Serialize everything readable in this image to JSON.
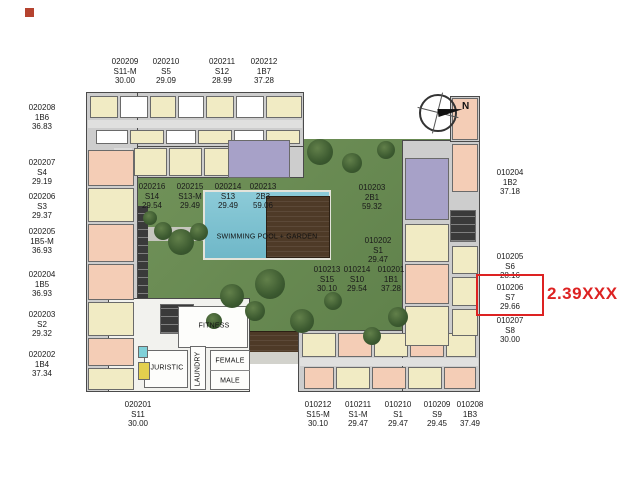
{
  "annotation": {
    "price_text": "2.39XXX",
    "highlight_color": "#dd2222",
    "highlighted_unit": "010206"
  },
  "compass": {
    "label": "N"
  },
  "facilities": {
    "pool_garden": "SWIMMING POOL + GARDEN",
    "fitness": "FITNESS",
    "juristic": "JURISTIC",
    "laundry": "LAUNDRY",
    "female": "FEMALE",
    "male": "MALE"
  },
  "colors": {
    "unit_cream": "#f1ebc4",
    "unit_salmon": "#f4cdb6",
    "unit_lavender": "#a7a1c8",
    "garden_green": "#6e9055",
    "pool_blue": "#7ec5d2",
    "deck_brown": "#4e3a27",
    "highlight_red": "#dd2222"
  },
  "units": [
    {
      "code": "020209",
      "type": "S11-M",
      "area": "30.00",
      "x": 125,
      "y": 57
    },
    {
      "code": "020210",
      "type": "S5",
      "area": "29.09",
      "x": 166,
      "y": 57
    },
    {
      "code": "020211",
      "type": "S12",
      "area": "28.99",
      "x": 222,
      "y": 57
    },
    {
      "code": "020212",
      "type": "1B7",
      "area": "37.28",
      "x": 264,
      "y": 57
    },
    {
      "code": "020208",
      "type": "1B6",
      "area": "36.83",
      "x": 42,
      "y": 103
    },
    {
      "code": "020207",
      "type": "S4",
      "area": "29.19",
      "x": 42,
      "y": 158
    },
    {
      "code": "020206",
      "type": "S3",
      "area": "29.37",
      "x": 42,
      "y": 192
    },
    {
      "code": "020205",
      "type": "1B5-M",
      "area": "36.93",
      "x": 42,
      "y": 227
    },
    {
      "code": "020204",
      "type": "1B5",
      "area": "36.93",
      "x": 42,
      "y": 270
    },
    {
      "code": "020203",
      "type": "S2",
      "area": "29.32",
      "x": 42,
      "y": 310
    },
    {
      "code": "020202",
      "type": "1B4",
      "area": "37.34",
      "x": 42,
      "y": 350
    },
    {
      "code": "020201",
      "type": "S11",
      "area": "30.00",
      "x": 138,
      "y": 400
    },
    {
      "code": "020216",
      "type": "S14",
      "area": "29.54",
      "x": 152,
      "y": 182
    },
    {
      "code": "020215",
      "type": "S13-M",
      "area": "29.49",
      "x": 190,
      "y": 182
    },
    {
      "code": "020214",
      "type": "S13",
      "area": "29.49",
      "x": 228,
      "y": 182
    },
    {
      "code": "020213",
      "type": "2B3",
      "area": "59.06",
      "x": 263,
      "y": 182
    },
    {
      "code": "010203",
      "type": "2B1",
      "area": "59.32",
      "x": 372,
      "y": 183
    },
    {
      "code": "010202",
      "type": "S1",
      "area": "29.47",
      "x": 378,
      "y": 236
    },
    {
      "code": "010213",
      "type": "S15",
      "area": "30.10",
      "x": 327,
      "y": 265
    },
    {
      "code": "010214",
      "type": "S10",
      "area": "29.54",
      "x": 357,
      "y": 265
    },
    {
      "code": "010201",
      "type": "1B1",
      "area": "37.28",
      "x": 391,
      "y": 265
    },
    {
      "code": "010204",
      "type": "1B2",
      "area": "37.18",
      "x": 510,
      "y": 168
    },
    {
      "code": "010205",
      "type": "S6",
      "area": "28.16",
      "x": 510,
      "y": 252
    },
    {
      "code": "010206",
      "type": "S7",
      "area": "29.66",
      "x": 510,
      "y": 283,
      "boxed": true
    },
    {
      "code": "010207",
      "type": "S8",
      "area": "30.00",
      "x": 510,
      "y": 316
    },
    {
      "code": "010212",
      "type": "S15-M",
      "area": "30.10",
      "x": 318,
      "y": 400
    },
    {
      "code": "010211",
      "type": "S1-M",
      "area": "29.47",
      "x": 358,
      "y": 400
    },
    {
      "code": "010210",
      "type": "S1",
      "area": "29.47",
      "x": 398,
      "y": 400
    },
    {
      "code": "010209",
      "type": "S9",
      "area": "29.45",
      "x": 437,
      "y": 400
    },
    {
      "code": "010208",
      "type": "1B3",
      "area": "37.49",
      "x": 470,
      "y": 400
    }
  ]
}
